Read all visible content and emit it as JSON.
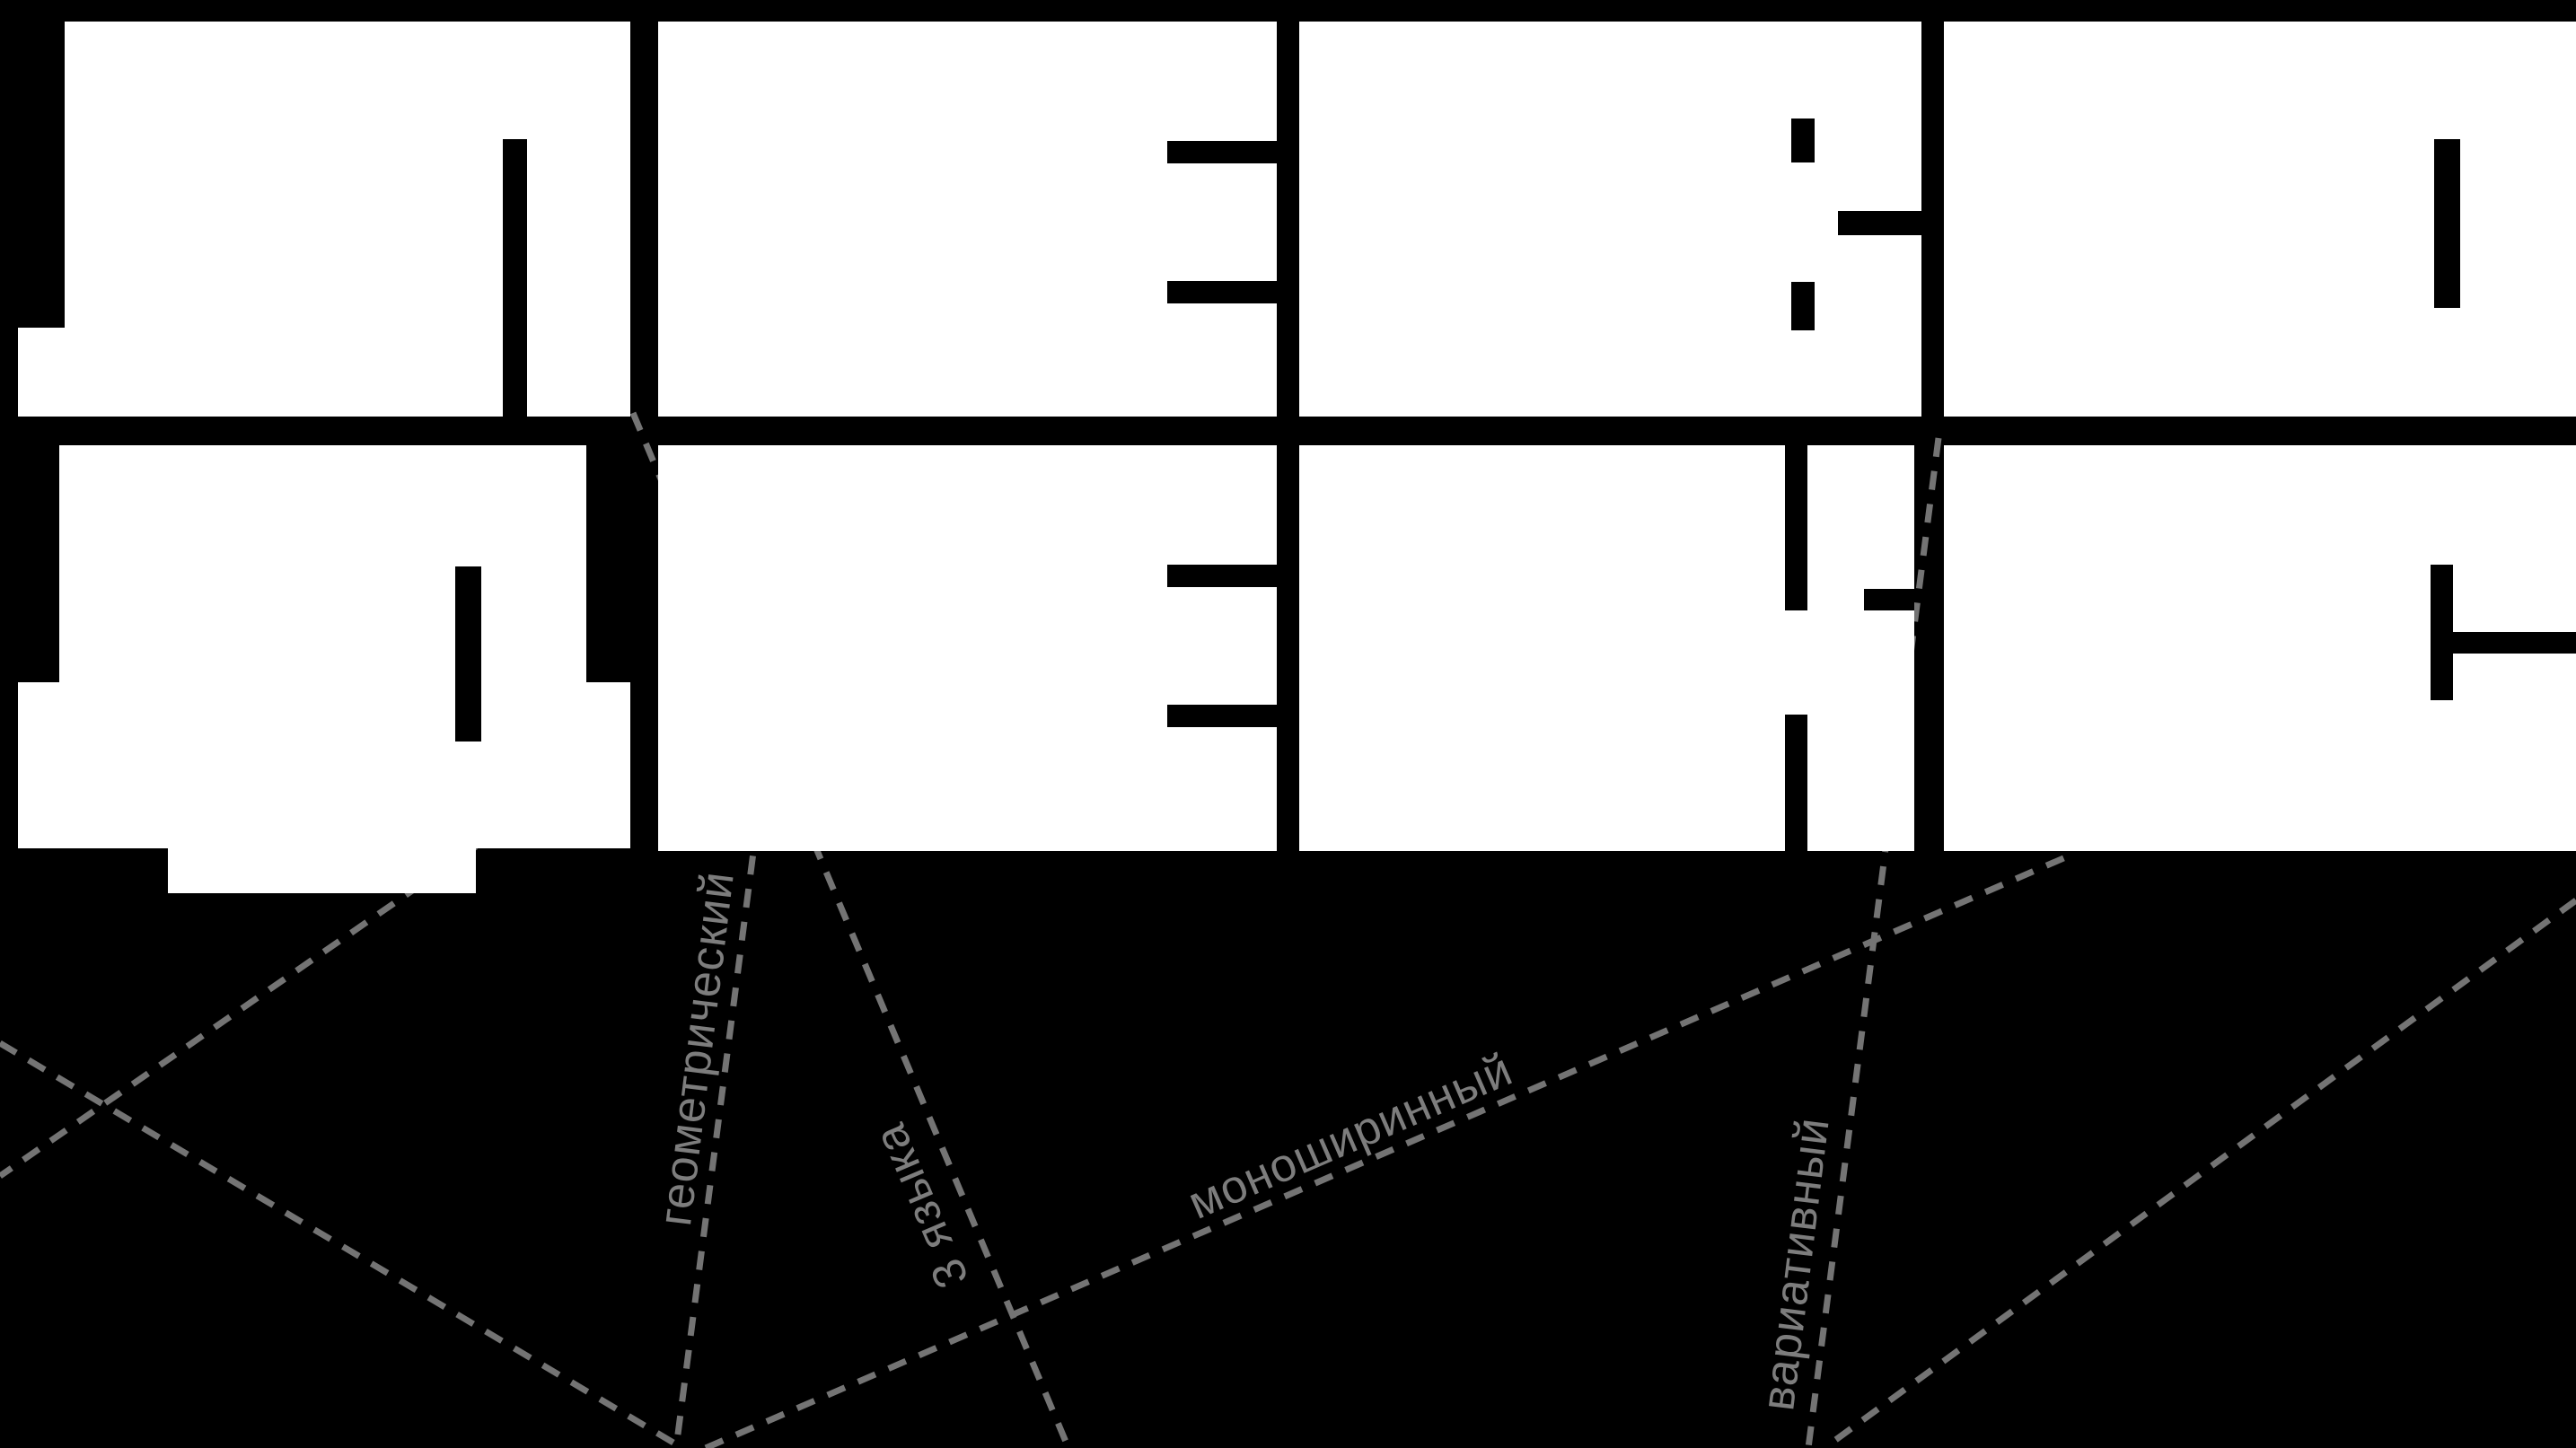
{
  "poster": {
    "background_color": "#000000",
    "letter_color": "#ffffff",
    "annotation_color": "#7d7d7d",
    "dotted_line_color": "#747474",
    "word_row_1": "ЛЕВО",
    "word_row_2": "ДЕКС",
    "glyphs": [
      {
        "char": "Л"
      },
      {
        "char": "Е"
      },
      {
        "char": "В"
      },
      {
        "char": "О"
      },
      {
        "char": "Д"
      },
      {
        "char": "Е"
      },
      {
        "char": "К"
      },
      {
        "char": "С"
      }
    ],
    "labels": [
      {
        "text": "геометрический"
      },
      {
        "text": "3 языка"
      },
      {
        "text": "моноширинный"
      },
      {
        "text": "вариативный"
      }
    ]
  }
}
